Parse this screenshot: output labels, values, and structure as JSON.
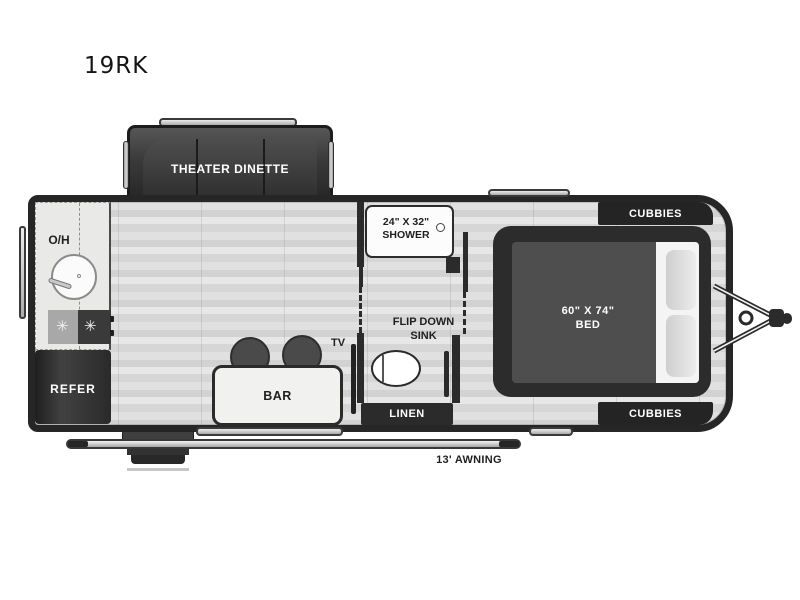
{
  "title": "19RK",
  "colors": {
    "wall": "#2b2b2b",
    "floor": "#d9d9d9",
    "dark_furniture": "#3a3a3a",
    "counter": "#e9e9e7",
    "fixture_white": "#fcfcfc",
    "label_dark": "#1f1f1f",
    "label_light": "#ffffff",
    "awning_silver": "#c9c9c9"
  },
  "floorplan": {
    "slideout": {
      "label": "THEATER DINETTE"
    },
    "kitchen": {
      "overhead_label": "O/H",
      "refrigerator_label": "REFER",
      "burner_glyph": "✳"
    },
    "bathroom": {
      "shower_size": "24\" X 32\"",
      "shower_label": "SHOWER",
      "sink_line1": "FLIP DOWN",
      "sink_line2": "SINK",
      "linen_label": "LINEN"
    },
    "living": {
      "bar_label": "BAR",
      "tv_label": "TV"
    },
    "bedroom": {
      "bed_size": "60\" X 74\"",
      "bed_label": "BED",
      "cubbies_top": "CUBBIES",
      "cubbies_bottom": "CUBBIES"
    },
    "exterior": {
      "awning_label": "13' AWNING"
    }
  }
}
